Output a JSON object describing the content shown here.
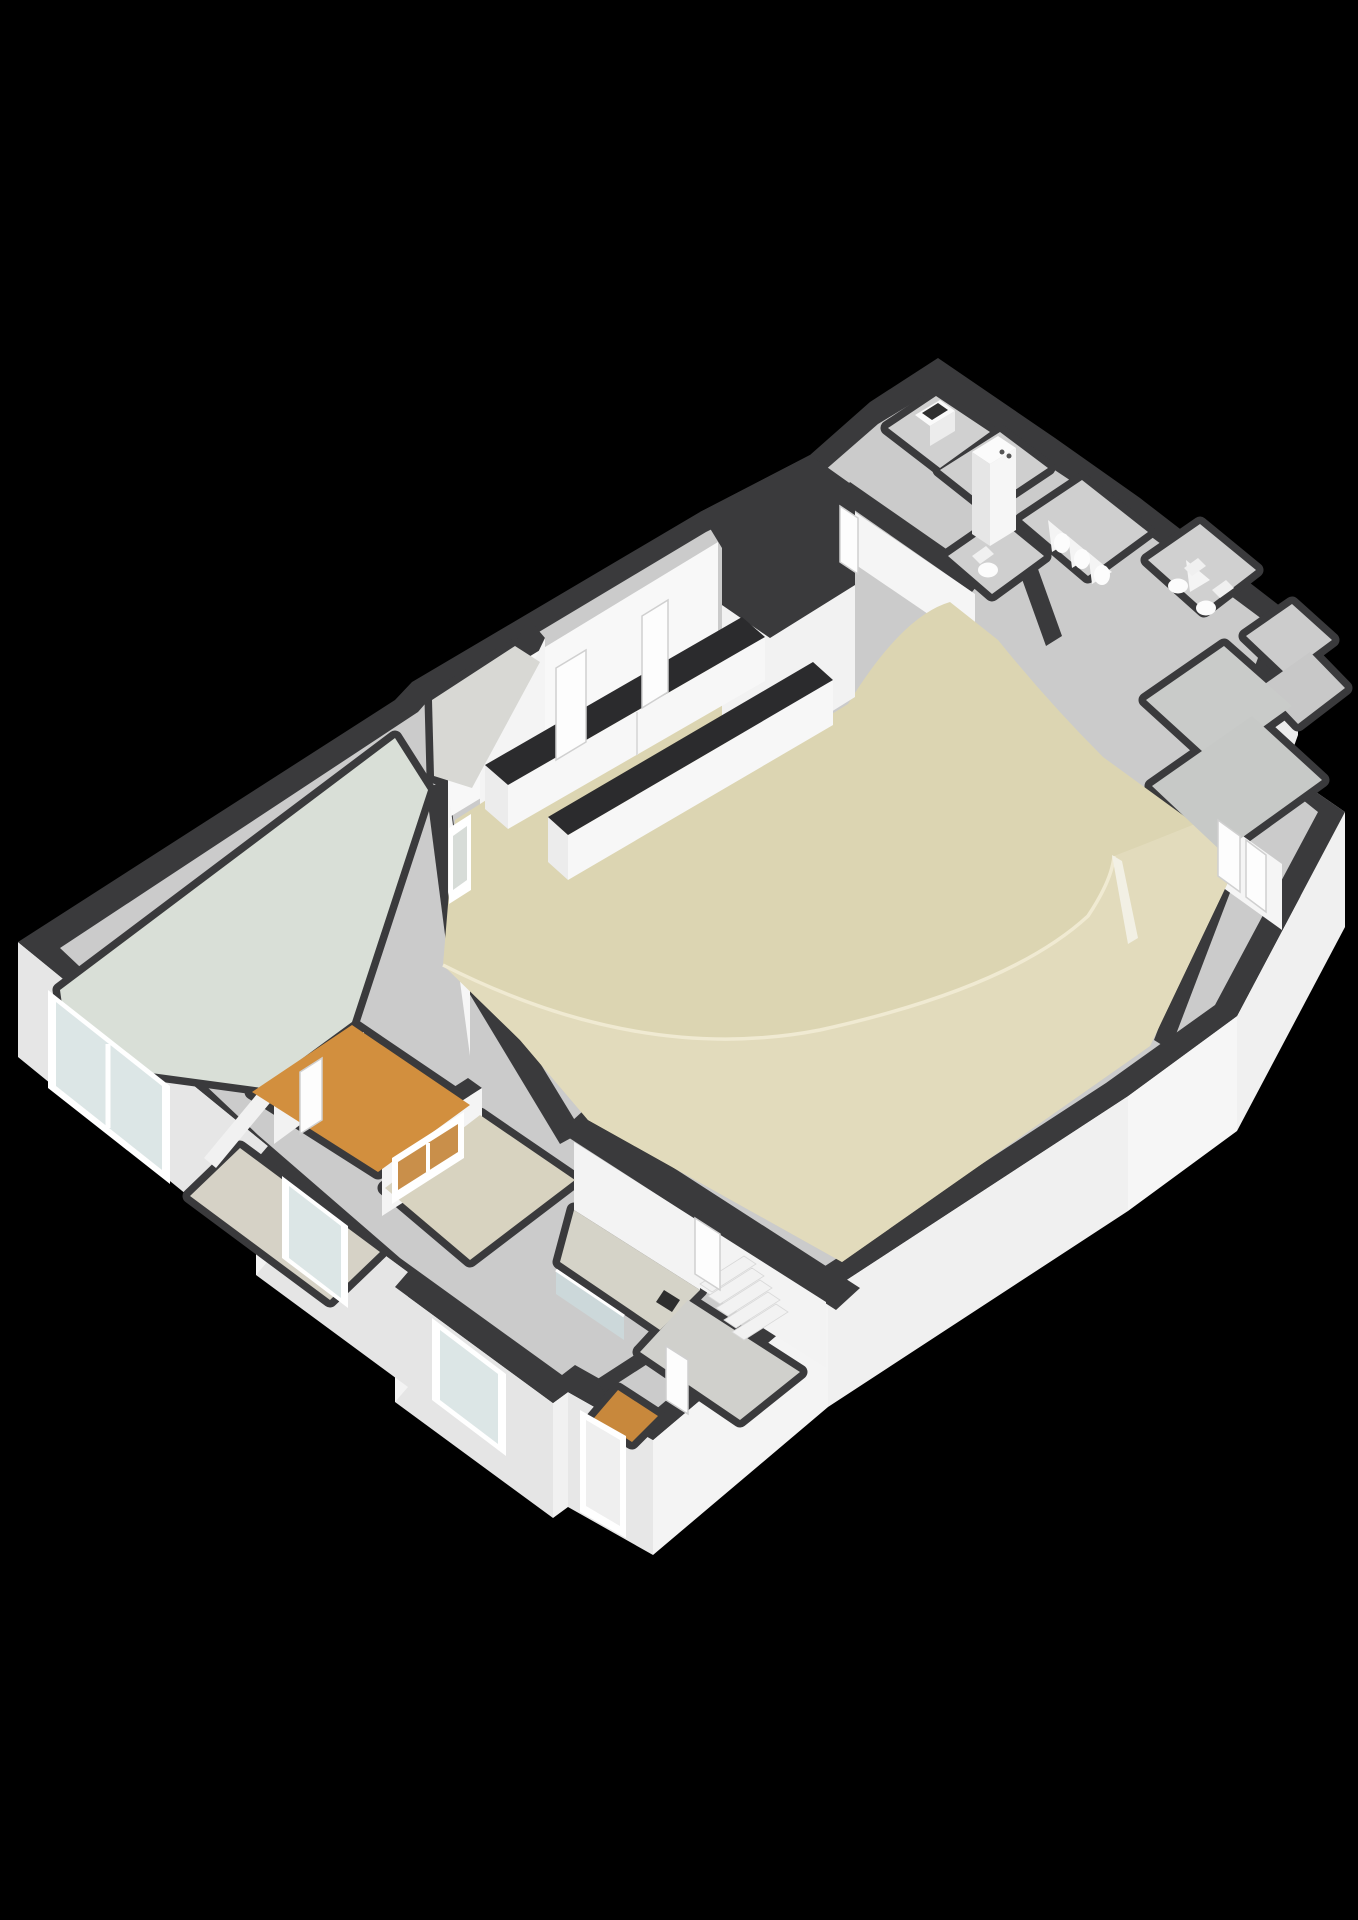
{
  "meta": {
    "title": "3D floor plan render",
    "view": "isometric-3d",
    "background": "#000000"
  },
  "colors": {
    "background": "#000000",
    "wall_top": "#3a3a3c",
    "base_floor": "#cbcbcb",
    "wall_face": "#f6f6f6",
    "wall_face_shadow": "#e6e6e6",
    "floor_hall": "#dcd5b2",
    "floor_platform": "#e2dbbc",
    "platform_edge": "#f0ead2",
    "floor_pale": "#d9dfd7",
    "floor_orange": "#d28f3e",
    "floor_beige2": "#d8d3c0",
    "floor_gray": "#d0d0d0",
    "floor_gray_dark": "#c7c9c7",
    "floor_wood": "#c8883c",
    "glass": "#dce6e6",
    "glass_tint": "#c98f4a",
    "fixture": "#fafafa",
    "counter_top": "#2b2b2d",
    "door": "#fdfdfd",
    "door_frame": "#d8d8d8"
  },
  "rooms": [
    {
      "name": "main-hall"
    },
    {
      "name": "stage-platform"
    },
    {
      "name": "pentagon-room"
    },
    {
      "name": "left-room"
    },
    {
      "name": "orange-room"
    },
    {
      "name": "serving-room"
    },
    {
      "name": "facade-room"
    },
    {
      "name": "corridor"
    },
    {
      "name": "vestibule"
    },
    {
      "name": "closet"
    },
    {
      "name": "sink-room"
    },
    {
      "name": "boiler-closet"
    },
    {
      "name": "urinal-room"
    },
    {
      "name": "toilet-room"
    },
    {
      "name": "wc"
    },
    {
      "name": "right-room-1"
    },
    {
      "name": "right-room-2"
    },
    {
      "name": "far-right-room-1"
    },
    {
      "name": "far-right-room-2"
    }
  ],
  "fixtures": [
    {
      "name": "counter-1"
    },
    {
      "name": "counter-2"
    },
    {
      "name": "sink-counter"
    },
    {
      "name": "boiler"
    },
    {
      "name": "urinal",
      "count": 3
    },
    {
      "name": "toilet",
      "count": 3
    },
    {
      "name": "stairs",
      "treads": 5
    },
    {
      "name": "entrance-door"
    },
    {
      "name": "facade-window",
      "count": 3
    }
  ]
}
